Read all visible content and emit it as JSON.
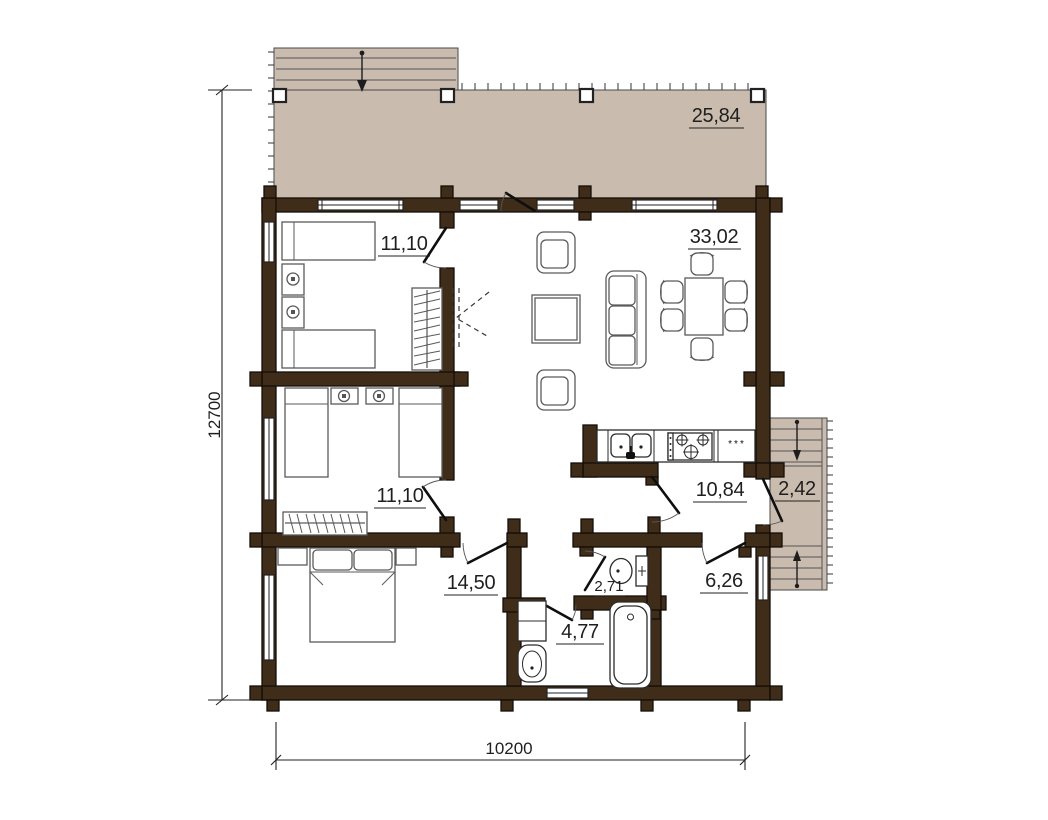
{
  "drawing": {
    "type": "floor-plan"
  },
  "rooms": {
    "terrace": "25,84",
    "bedroom_top": "11,10",
    "living": "33,02",
    "kitchen": "10,84",
    "porch": "2,42",
    "bedroom_mid": "11,10",
    "bedroom_bottom": "14,50",
    "wc": "2,71",
    "hall": "6,26",
    "bath": "4,77"
  },
  "dimensions": {
    "vertical": "12700",
    "horizontal": "10200"
  },
  "kitchen_fixtures": {
    "counter_mark": "***"
  },
  "colors": {
    "wall": "#3f2d1a",
    "deck": "#c9bcae",
    "line": "#222222"
  }
}
